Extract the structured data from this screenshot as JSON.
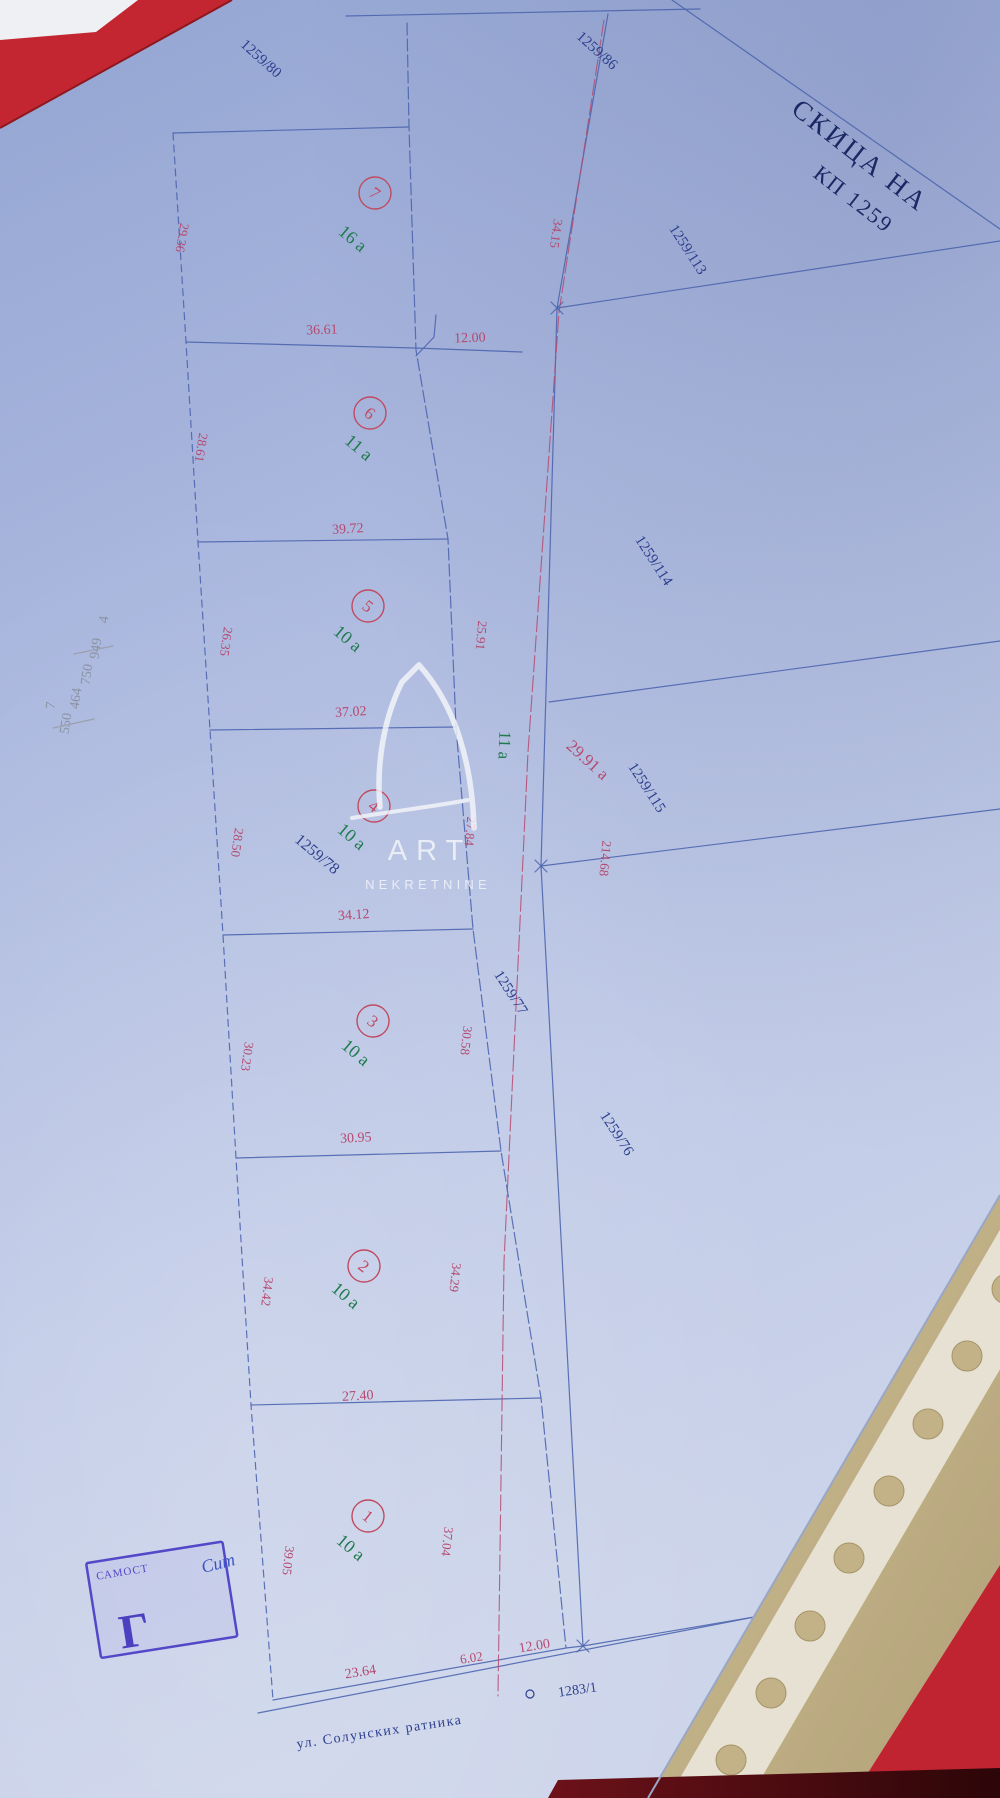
{
  "title": {
    "line1": "СКИЦА НА",
    "line2": "КП 1259"
  },
  "watermark": {
    "line1": "ART",
    "line2": "NEKRETNINE"
  },
  "street": {
    "name": "ул. Солунских ратника",
    "parcel": "1283/1"
  },
  "parcels": {
    "nw": "1259/80",
    "north": "1259/86",
    "east1": "1259/113",
    "east2": "1259/114",
    "east3": "1259/115",
    "road": "1259/77",
    "southeast": "1259/76",
    "strip": "1259/78"
  },
  "road": {
    "label": "11 a",
    "area": "29.91 a",
    "length": "214.68",
    "width_top": "12.00",
    "width_bottom": "12.00",
    "gap_bottom": "6.02",
    "east_top_dim": "34.15"
  },
  "plots": [
    {
      "num": "1",
      "area": "10 a",
      "left": "39.05",
      "right": "37.04",
      "bottom": "23.64"
    },
    {
      "num": "2",
      "area": "10 a",
      "left": "34.42",
      "right": "34.29",
      "bottom": "27.40"
    },
    {
      "num": "3",
      "area": "10 a",
      "left": "30.23",
      "right": "30.58",
      "bottom": "30.95"
    },
    {
      "num": "4",
      "area": "10 a",
      "left": "28.50",
      "right": "27.84",
      "bottom": "34.12"
    },
    {
      "num": "5",
      "area": "10 a",
      "left": "26.35",
      "right": "25.91",
      "bottom": "37.02"
    },
    {
      "num": "6",
      "area": "11 a",
      "left": "28.61",
      "bottom": "39.72"
    },
    {
      "num": "7",
      "area": "16 a",
      "left": "29.36",
      "bottom": "36.61"
    }
  ],
  "pencil_notes": {
    "n1": "4",
    "n2": "949",
    "n3": "750",
    "n4": "464",
    "n5": "550",
    "n6": "7"
  },
  "stamp": {
    "header": "САМОСТ",
    "letter": "Г",
    "handwriting": "Сит"
  }
}
